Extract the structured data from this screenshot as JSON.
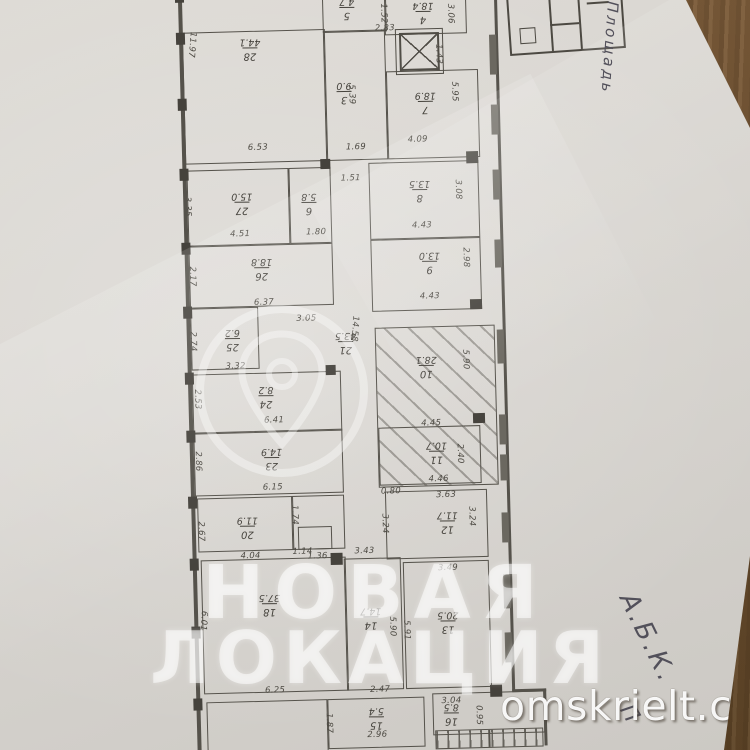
{
  "scene": {
    "paper_color": "#d8d5d0",
    "table_color": "#6e5132",
    "ink_color": "#4c4942"
  },
  "watermark": {
    "line1": "НОВАЯ",
    "line2": "ЛОКАЦИЯ",
    "site": "omskrielt.com",
    "logo": "location-pin-in-circle"
  },
  "handwriting": [
    {
      "text": "Площадь",
      "x": 622,
      "y": 2,
      "rot": 94,
      "size": 15
    },
    {
      "text": "А.Б.К.",
      "x": 640,
      "y": 588,
      "rot": 64,
      "size": 26
    },
    {
      "text": "П",
      "x": 636,
      "y": 700,
      "rot": 60,
      "size": 22
    }
  ],
  "plan": {
    "rooms": [
      {
        "num": "28",
        "area": "44.1",
        "x": 5,
        "y": 40,
        "w": 141,
        "h": 130,
        "lx": 62,
        "ly": 46
      },
      {
        "num": "5",
        "area": "4.7",
        "x": 146,
        "y": -10,
        "w": 62,
        "h": 52,
        "lx": 163,
        "ly": 8
      },
      {
        "num": "4",
        "area": "18.4",
        "x": 208,
        "y": -10,
        "w": 80,
        "h": 56,
        "lx": 236,
        "ly": 14
      },
      {
        "num": "3",
        "area": "9.0",
        "x": 146,
        "y": 42,
        "w": 60,
        "h": 128,
        "lx": 158,
        "ly": 92
      },
      {
        "num": "7",
        "area": "18.9",
        "x": 208,
        "y": 84,
        "w": 90,
        "h": 86,
        "lx": 236,
        "ly": 104
      },
      {
        "num": "27",
        "area": "15.0",
        "x": 6,
        "y": 178,
        "w": 100,
        "h": 74,
        "lx": 50,
        "ly": 200
      },
      {
        "num": "6",
        "area": "5.8",
        "x": 108,
        "y": 178,
        "w": 40,
        "h": 74,
        "lx": 120,
        "ly": 202
      },
      {
        "num": "8",
        "area": "13.5",
        "x": 188,
        "y": 175,
        "w": 108,
        "h": 75,
        "lx": 228,
        "ly": 192
      },
      {
        "num": "26",
        "area": "18.8",
        "x": 6,
        "y": 254,
        "w": 142,
        "h": 60,
        "lx": 68,
        "ly": 266
      },
      {
        "num": "9",
        "area": "13.0",
        "x": 188,
        "y": 252,
        "w": 108,
        "h": 70,
        "lx": 236,
        "ly": 264
      },
      {
        "num": "25",
        "area": "6.2",
        "x": 6,
        "y": 316,
        "w": 66,
        "h": 60,
        "lx": 40,
        "ly": 336
      },
      {
        "num": "21",
        "area": "43.5",
        "x": 148,
        "y": 252,
        "w": 40,
        "h": 320,
        "lx": 150,
        "ly": 342,
        "open": true
      },
      {
        "num": "10",
        "area": "28.1",
        "x": 190,
        "y": 340,
        "w": 118,
        "h": 158,
        "lx": 230,
        "ly": 368,
        "hatch": true
      },
      {
        "num": "24",
        "area": "8.2",
        "x": 6,
        "y": 382,
        "w": 147,
        "h": 58,
        "lx": 72,
        "ly": 394
      },
      {
        "num": "23",
        "area": "14.9",
        "x": 6,
        "y": 440,
        "w": 147,
        "h": 62,
        "lx": 73,
        "ly": 456
      },
      {
        "num": "11",
        "area": "10.7",
        "x": 191,
        "y": 440,
        "w": 100,
        "h": 56,
        "lx": 238,
        "ly": 454
      },
      {
        "num": "12",
        "area": "11.7",
        "x": 196,
        "y": 504,
        "w": 100,
        "h": 66,
        "lx": 247,
        "ly": 524
      },
      {
        "num": "20",
        "area": "11.9",
        "x": 8,
        "y": 506,
        "w": 94,
        "h": 52,
        "lx": 47,
        "ly": 524
      },
      {
        "x": 102,
        "y": 506,
        "w": 51,
        "h": 52
      },
      {
        "x": 108,
        "y": 537,
        "w": 32,
        "h": 21
      },
      {
        "num": "14",
        "area": "14.7",
        "x": 153,
        "y": 570,
        "w": 55,
        "h": 130,
        "lx": 168,
        "ly": 618
      },
      {
        "num": "13",
        "area": "20.5",
        "x": 212,
        "y": 575,
        "w": 84,
        "h": 125,
        "lx": 245,
        "ly": 624
      },
      {
        "num": "18",
        "area": "37.5",
        "x": 10,
        "y": 568,
        "w": 143,
        "h": 132,
        "lx": 67,
        "ly": 602
      },
      {
        "num": "15",
        "area": "5.4",
        "x": 133,
        "y": 710,
        "w": 95,
        "h": 48,
        "lx": 174,
        "ly": 718
      },
      {
        "num": "16",
        "area": "8.5",
        "x": 238,
        "y": 707,
        "w": 110,
        "h": 40,
        "lx": 249,
        "ly": 716
      },
      {
        "x": 12,
        "y": 710,
        "w": 119,
        "h": 52
      }
    ],
    "dims": [
      {
        "t": "11.97",
        "x": 21,
        "y": 40,
        "r": 96
      },
      {
        "t": "6.53",
        "x": 68,
        "y": 152
      },
      {
        "t": "2.83",
        "x": 198,
        "y": 36
      },
      {
        "t": "1.52",
        "x": 212,
        "y": 16,
        "r": 90
      },
      {
        "t": "3.06",
        "x": 279,
        "y": 18,
        "r": 90
      },
      {
        "t": "1.43",
        "x": 266,
        "y": 58,
        "r": 90
      },
      {
        "t": "5.39",
        "x": 178,
        "y": 96,
        "r": 90
      },
      {
        "t": "1.69",
        "x": 166,
        "y": 154
      },
      {
        "t": "4.09",
        "x": 228,
        "y": 148
      },
      {
        "t": "5.95",
        "x": 281,
        "y": 96,
        "r": 90
      },
      {
        "t": "3.35",
        "x": 11,
        "y": 204,
        "r": 90
      },
      {
        "t": "4.51",
        "x": 48,
        "y": 238
      },
      {
        "t": "1.80",
        "x": 124,
        "y": 238
      },
      {
        "t": "1.51",
        "x": 160,
        "y": 185
      },
      {
        "t": "4.43",
        "x": 230,
        "y": 234
      },
      {
        "t": "3.08",
        "x": 282,
        "y": 194,
        "r": 90
      },
      {
        "t": "2.17",
        "x": 14,
        "y": 274,
        "r": 90
      },
      {
        "t": "6.37",
        "x": 70,
        "y": 307
      },
      {
        "t": "4.43",
        "x": 236,
        "y": 305
      },
      {
        "t": "2.98",
        "x": 288,
        "y": 262,
        "r": 90
      },
      {
        "t": "2.74",
        "x": 13,
        "y": 339,
        "r": 90
      },
      {
        "t": "3.32",
        "x": 40,
        "y": 370
      },
      {
        "t": "3.05",
        "x": 112,
        "y": 324
      },
      {
        "t": "14.58",
        "x": 176,
        "y": 328,
        "r": 95
      },
      {
        "t": "5.90",
        "x": 285,
        "y": 364,
        "r": 90
      },
      {
        "t": "4.45",
        "x": 234,
        "y": 432
      },
      {
        "t": "4.46",
        "x": 240,
        "y": 488
      },
      {
        "t": "2.53",
        "x": 16,
        "y": 397,
        "r": 90
      },
      {
        "t": "6.41",
        "x": 77,
        "y": 425
      },
      {
        "t": "2.86",
        "x": 15,
        "y": 459,
        "r": 90
      },
      {
        "t": "6.15",
        "x": 74,
        "y": 492
      },
      {
        "t": "2.40",
        "x": 277,
        "y": 458,
        "r": 90
      },
      {
        "t": "0.80",
        "x": 192,
        "y": 499
      },
      {
        "t": "3.63",
        "x": 247,
        "y": 504
      },
      {
        "t": "3.24",
        "x": 287,
        "y": 521,
        "r": 90
      },
      {
        "t": "3.24",
        "x": 200,
        "y": 526,
        "r": 90
      },
      {
        "t": "2.67",
        "x": 16,
        "y": 529,
        "r": 90
      },
      {
        "t": "4.04",
        "x": 50,
        "y": 560
      },
      {
        "t": "1.74",
        "x": 110,
        "y": 515,
        "r": 90
      },
      {
        "t": "1.14",
        "x": 102,
        "y": 557
      },
      {
        "t": "1.36",
        "x": 117,
        "y": 562
      },
      {
        "t": "3.43",
        "x": 164,
        "y": 558
      },
      {
        "t": "3.49",
        "x": 247,
        "y": 577
      },
      {
        "t": "5.90",
        "x": 205,
        "y": 629,
        "r": 90
      },
      {
        "t": "5.91",
        "x": 219,
        "y": 633,
        "r": 90
      },
      {
        "t": "6.01",
        "x": 17,
        "y": 619,
        "r": 95
      },
      {
        "t": "6.25",
        "x": 71,
        "y": 695
      },
      {
        "t": "2.47",
        "x": 176,
        "y": 697
      },
      {
        "t": "2.96",
        "x": 172,
        "y": 742
      },
      {
        "t": "1.87",
        "x": 139,
        "y": 724,
        "r": 90
      },
      {
        "t": "3.04",
        "x": 247,
        "y": 710
      },
      {
        "t": "0.95",
        "x": 289,
        "y": 720,
        "r": 90
      }
    ],
    "walls": [
      {
        "x": 2,
        "y": -10,
        "w": 4,
        "h": 772
      },
      {
        "x": 318,
        "y": -10,
        "w": 3,
        "h": 717
      },
      {
        "x": 318,
        "y": 705,
        "w": 34,
        "h": 3
      },
      {
        "x": 349,
        "y": 705,
        "w": 3,
        "h": 57
      }
    ],
    "piers": [
      {
        "x": -1,
        "y": -2,
        "w": 9,
        "h": 12
      },
      {
        "x": -1,
        "y": 40,
        "w": 9,
        "h": 12
      },
      {
        "x": -1,
        "y": 106,
        "w": 9,
        "h": 12
      },
      {
        "x": -1,
        "y": 176,
        "w": 9,
        "h": 12
      },
      {
        "x": -1,
        "y": 250,
        "w": 9,
        "h": 12
      },
      {
        "x": -1,
        "y": 314,
        "w": 9,
        "h": 12
      },
      {
        "x": -1,
        "y": 380,
        "w": 9,
        "h": 12
      },
      {
        "x": -1,
        "y": 438,
        "w": 9,
        "h": 12
      },
      {
        "x": -1,
        "y": 504,
        "w": 9,
        "h": 12
      },
      {
        "x": -1,
        "y": 566,
        "w": 9,
        "h": 12
      },
      {
        "x": -1,
        "y": 634,
        "w": 9,
        "h": 12
      },
      {
        "x": -1,
        "y": 706,
        "w": 9,
        "h": 12
      },
      {
        "x": 286,
        "y": 166,
        "w": 12,
        "h": 12
      },
      {
        "x": 286,
        "y": 314,
        "w": 12,
        "h": 10
      },
      {
        "x": 286,
        "y": 428,
        "w": 12,
        "h": 10
      },
      {
        "x": 140,
        "y": 170,
        "w": 10,
        "h": 10
      },
      {
        "x": 140,
        "y": 376,
        "w": 10,
        "h": 10
      },
      {
        "x": 140,
        "y": 564,
        "w": 12,
        "h": 12
      },
      {
        "x": 296,
        "y": 700,
        "w": 12,
        "h": 12
      }
    ],
    "windows": [
      {
        "x": 312,
        "y": 50,
        "h": 40
      },
      {
        "x": 312,
        "y": 120,
        "h": 30
      },
      {
        "x": 312,
        "y": 185,
        "h": 30
      },
      {
        "x": 312,
        "y": 255,
        "h": 28
      },
      {
        "x": 312,
        "y": 345,
        "h": 34
      },
      {
        "x": 312,
        "y": 430,
        "h": 30
      },
      {
        "x": 312,
        "y": 470,
        "h": 26
      },
      {
        "x": 312,
        "y": 528,
        "h": 30
      },
      {
        "x": 312,
        "y": 590,
        "h": 34
      },
      {
        "x": 312,
        "y": 648,
        "h": 30
      }
    ],
    "elevator": {
      "x": 222,
      "y": 46,
      "w": 36,
      "h": 34
    },
    "stairs": {
      "x": 240,
      "y": 744,
      "w": 106,
      "h": 17
    }
  }
}
